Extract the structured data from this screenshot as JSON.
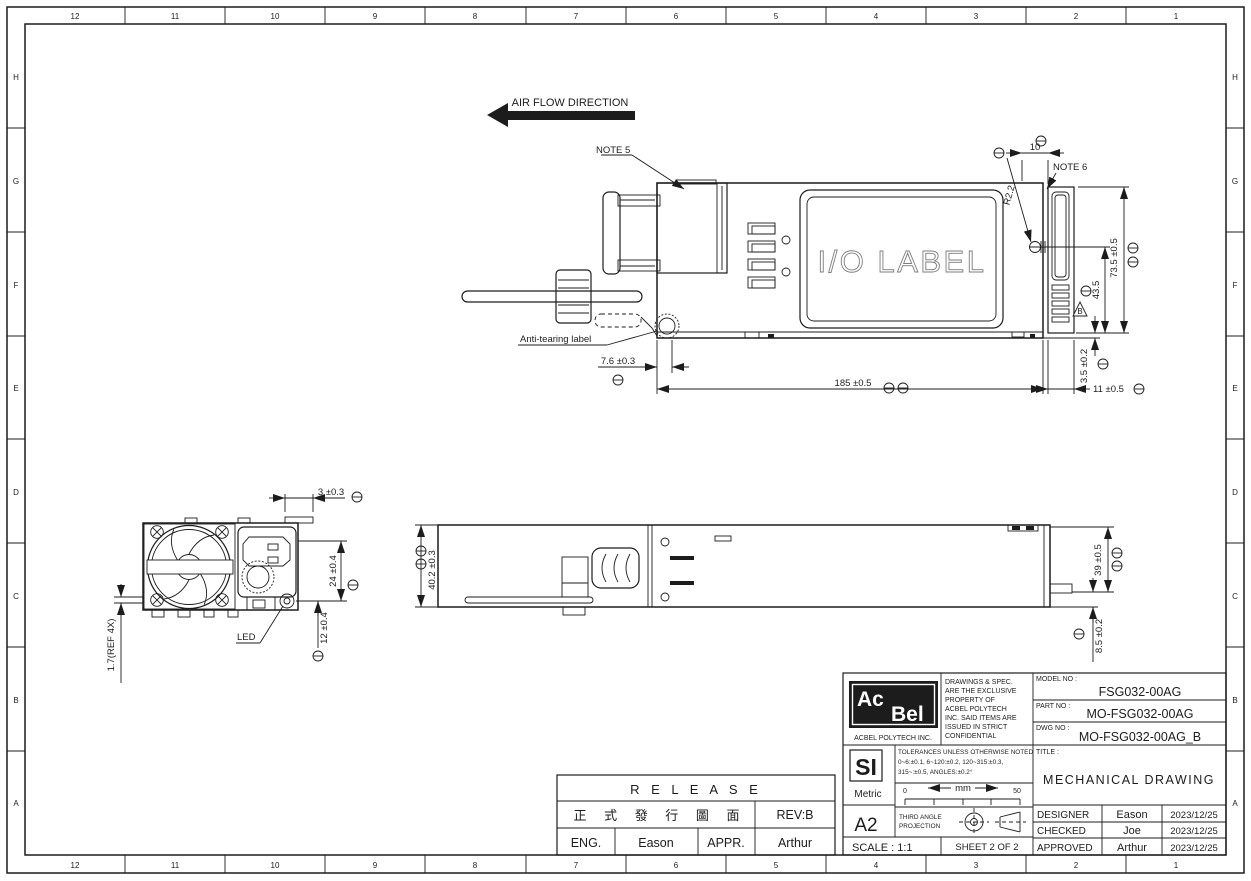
{
  "sheet": {
    "cols": [
      "12",
      "11",
      "10",
      "9",
      "8",
      "7",
      "6",
      "5",
      "4",
      "3",
      "2",
      "1"
    ],
    "rows": [
      "H",
      "G",
      "F",
      "E",
      "D",
      "C",
      "B",
      "A"
    ]
  },
  "annotations": {
    "air_flow": "AIR FLOW DIRECTION",
    "note5": "NOTE 5",
    "note6": "NOTE 6",
    "anti_tearing": "Anti-tearing label",
    "io_label": "I/O LABEL",
    "led": "LED",
    "datum_b": "B"
  },
  "dims": {
    "d10": "10",
    "r22": "R2.2",
    "h735": "73.5 ±0.5",
    "h435": "43.5",
    "v35": "3.5 ±0.2",
    "w11": "11 ±0.5",
    "w185": "185 ±0.5",
    "w76": "7.6 ±0.3",
    "w3": "3 ±0.3",
    "h24": "24 ±0.4",
    "h12": "12 ±0.4",
    "ref17": "1.7(REF 4X)",
    "h402": "40.2 ±0.3",
    "h39": "39 ±0.5",
    "h85": "8.5 ±0.2"
  },
  "release": {
    "title": "R E L E A S E",
    "cn": "正 式 發 行 圖 面",
    "rev": "REV:B",
    "eng_label": "ENG.",
    "eng_name": "Eason",
    "appr_label": "APPR.",
    "appr_name": "Arthur"
  },
  "tb": {
    "logo_top": "Ac",
    "logo_bottom": "Bel",
    "company": "ACBEL POLYTECH INC.",
    "confidential": [
      "DRAWINGS & SPEC.",
      "ARE THE EXCLUSIVE",
      "PROPERTY OF",
      "ACBEL POLYTECH",
      "INC. SAID ITEMS ARE",
      "ISSUED IN STRICT",
      "CONFIDENTIAL"
    ],
    "model_label": "MODEL NO :",
    "model": "FSG032-00AG",
    "part_label": "PART NO :",
    "part": "MO-FSG032-00AG",
    "dwg_label": "DWG NO :",
    "dwg": "MO-FSG032-00AG_B",
    "si": "SI",
    "metric": "Metric",
    "size": "A2",
    "tol_title": "TOLERANCES UNLESS OTHERWISE NOTED",
    "tol1": "0~6:±0.1,   6~120:±0.2,   120~315:±0.3,",
    "tol2": "315~:±0.5,   ANGLES:±0.2°",
    "ruler_zero": "0",
    "ruler_unit": "mm",
    "ruler_fifty": "50",
    "proj1": "THIRD ANGLE",
    "proj2": "PROJECTION",
    "title_label": "TITLE :",
    "title": "MECHANICAL DRAWING",
    "rows": [
      {
        "role": "DESIGNER",
        "name": "Eason",
        "date": "2023/12/25"
      },
      {
        "role": "CHECKED",
        "name": "Joe",
        "date": "2023/12/25"
      },
      {
        "role": "APPROVED",
        "name": "Arthur",
        "date": "2023/12/25"
      }
    ],
    "scale": "SCALE : 1:1",
    "sheet_no": "SHEET  2  OF  2"
  }
}
